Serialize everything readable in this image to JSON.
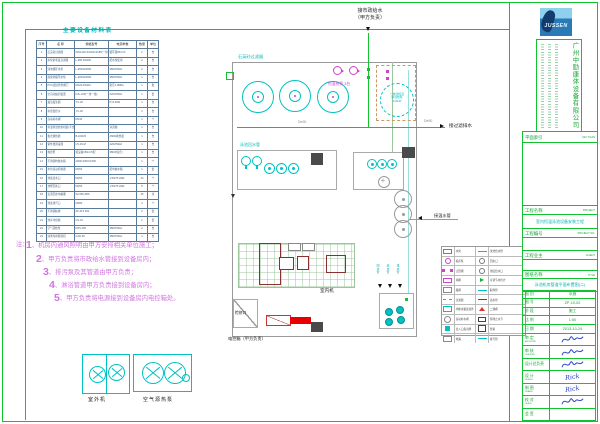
{
  "equipment_table": {
    "title": "主要设备材料表",
    "headers": [
      "序号",
      "名 称",
      "规格型号",
      "电源参数",
      "数量",
      "单位"
    ],
    "rows": [
      [
        "1",
        "石英砂过滤器",
        "WG1400 Φ1400×2180(一用一备)",
        "循环量80m³/h",
        "2",
        "台"
      ],
      [
        "2",
        "水泵前毛发过滤器",
        "L-380 DN100",
        "配水泵使用",
        "2",
        "台"
      ],
      [
        "3",
        "泳池循环水泵",
        "L-380/2200W",
        "380V/50Hz",
        "2",
        "台"
      ],
      [
        "4",
        "按摩池循环水泵",
        "L-380/2200W",
        "380V/50Hz",
        "1",
        "台"
      ],
      [
        "5",
        "PVC连接管件阀门",
        "DN20-DN110",
        "耐压1.0MPa",
        "1",
        "批"
      ],
      [
        "6",
        "全自动加药装置",
        "DJL-220(一用一备)",
        "220V/50Hz",
        "1",
        "套"
      ],
      [
        "7",
        "臭氧发生器",
        "YC-20",
        "P=0.2kW",
        "1",
        "台"
      ],
      [
        "8",
        "水质监控仪",
        "YC-20",
        "",
        "1",
        "台"
      ],
      [
        "9",
        "自动补水阀",
        "DN40",
        "",
        "1",
        "个"
      ],
      [
        "10",
        "恒温除湿热泵机组(不含安装)",
        "",
        "详见图",
        "1",
        "台"
      ],
      [
        "11",
        "板式换热器",
        "B-220/26",
        "26kW换热量",
        "1",
        "台"
      ],
      [
        "12",
        "紫外线消毒器",
        "UV-15-M",
        "220V/50Hz",
        "1",
        "台"
      ],
      [
        "13",
        "电控柜",
        "按设备150m³/h配",
        "380V(综合)",
        "1",
        "台"
      ],
      [
        "14",
        "不锈钢均衡水箱",
        "2000×1500×1500",
        "",
        "1",
        "个"
      ],
      [
        "15",
        "水位自动控制器",
        "DN50",
        "配均衡水箱",
        "1",
        "套"
      ],
      [
        "16",
        "池底给水口",
        "DN50",
        "1:50/75-40W",
        "24",
        "个"
      ],
      [
        "17",
        "池壁回水口",
        "DN50",
        "1:50/75-40W",
        "8",
        "个"
      ],
      [
        "18",
        "溢流回水沟格栅",
        "W=250 ABS",
        "",
        "45",
        "米"
      ],
      [
        "19",
        "池底排污口",
        "DN80",
        "",
        "4",
        "个"
      ],
      [
        "20",
        "不锈钢扶梯",
        "SF-215 304",
        "",
        "2",
        "套"
      ],
      [
        "21",
        "池岸冲身器",
        "CS-01",
        "",
        "2",
        "套"
      ],
      [
        "22",
        "空气源热泵",
        "KRS-150",
        "380V/50Hz",
        "2",
        "台"
      ],
      [
        "23",
        "泳池专用除湿机",
        "CAD-35",
        "380V/50Hz",
        "1",
        "台"
      ]
    ]
  },
  "notes": {
    "prefix": "注：",
    "items": [
      {
        "num": "1",
        "text": "、机房内通风照明由甲方安排相关单位施工；"
      },
      {
        "num": "2",
        "text": "、甲方负责将市政给水管接到设备房内；"
      },
      {
        "num": "3",
        "text": "、排污泵及其管道由甲方负责；"
      },
      {
        "num": "4",
        "text": "、淋浴管道甲方负责接到设备房内；"
      },
      {
        "num": "5",
        "text": "、甲方负责将电源接到设备房内电控箱处。"
      }
    ]
  },
  "plan": {
    "labels": {
      "municipal_supply_1": "接市政给水",
      "municipal_supply_2": "（甲方负责）",
      "filter": "石英砂过滤器",
      "heat_pump_count": "恒温热泵 3台",
      "dehumidifier_1": "一体化恒温",
      "dehumidifier_2": "除湿热泵",
      "dehumidifier_3": "220kW",
      "pipe_de90": "De90",
      "pipe_de50": "De50",
      "drain": "接过滤排水",
      "return_main": "泳池回水管",
      "warm_water": "接温水管",
      "indoor_unit": "室内机",
      "access_hatch": "检修口",
      "control_box": "电控箱（甲方负责）",
      "riser_1": "回水管",
      "riser_2": "给水管",
      "riser_3": "排水管"
    }
  },
  "details": {
    "outdoor_unit_label": "室外机",
    "air_source_label": "空气源热泵"
  },
  "legend": {
    "rows": [
      {
        "s1": "m-rect",
        "n1": "水泵",
        "s2": "c-line",
        "n2": "泳池给水管"
      },
      {
        "s1": "m-pump",
        "n1": "投药泵",
        "s2": "a-circ",
        "n2": "回水口"
      },
      {
        "s1": "m-valve",
        "n1": "止回阀",
        "s2": "a-circ",
        "n2": "池底给水口"
      },
      {
        "s1": "m-rect",
        "n1": "闸阀",
        "s2": "g-flag",
        "n2": "可调节水位计"
      },
      {
        "s1": "w-box",
        "n1": "蝶阀",
        "s2": "c-line",
        "n2": "取样管"
      },
      {
        "s1": "c-dash",
        "n1": "过滤器",
        "s2": "b-line",
        "n2": "溢水管"
      },
      {
        "s1": "c-rect",
        "n1": "均衡水箱连接件",
        "s2": "r-cone",
        "n2": "二通阀"
      },
      {
        "s1": "g-circ",
        "n1": "自动补水阀",
        "s2": "k-fit",
        "n2": "预埋止水节"
      },
      {
        "s1": "c-fill",
        "n1": "出入口指示牌",
        "s2": "k-box",
        "n2": "管堵"
      },
      {
        "s1": "w-box",
        "n1": "地漏",
        "s2": "c-line",
        "n2": "排污管"
      }
    ]
  },
  "titleblock": {
    "logo_text": "JUSSEN",
    "company": "广州中励康体设备有限公司",
    "key_plan_zh": "平面索引",
    "key_plan_en": "KEY PLAN",
    "project_zh": "工程名称",
    "project_en": "PROJECT",
    "project_value": "室内恒温泳池设备安装工程",
    "project_no_zh": "工程编号",
    "project_no_en": "PROJECT NO.",
    "client_zh": "工程业主",
    "client_en": "CLIENT",
    "title_zh": "图纸名称",
    "title_en": "TITLE",
    "title_value": "泳池机房管道平面布置图(二)",
    "rows": [
      {
        "label": "图  别",
        "en": "",
        "value": "水施",
        "sig": ""
      },
      {
        "label": "图  号",
        "en": "",
        "value": "ZP-10-02",
        "sig": ""
      },
      {
        "label": "阶  段",
        "en": "",
        "value": "施工",
        "sig": ""
      },
      {
        "label": "比  例",
        "en": "",
        "value": "1:50",
        "sig": ""
      },
      {
        "label": "日  期",
        "en": "",
        "value": "2013-10-24",
        "sig": ""
      },
      {
        "label": "审  定",
        "en": "APPROVED",
        "value": "",
        "sig": "scribble"
      },
      {
        "label": "审  核",
        "en": "CHECKED",
        "value": "",
        "sig": "scribble"
      },
      {
        "label": "设计总负责",
        "en": "",
        "value": "",
        "sig": "scribble"
      },
      {
        "label": "设  计",
        "en": "DESIGN",
        "value": "",
        "sig": "Rick"
      },
      {
        "label": "制  图",
        "en": "DRAWN",
        "value": "",
        "sig": "Rick"
      },
      {
        "label": "校  对",
        "en": "CHECK",
        "value": "",
        "sig": "scribble"
      },
      {
        "label": "会  签",
        "en": "",
        "value": "",
        "sig": ""
      }
    ]
  }
}
